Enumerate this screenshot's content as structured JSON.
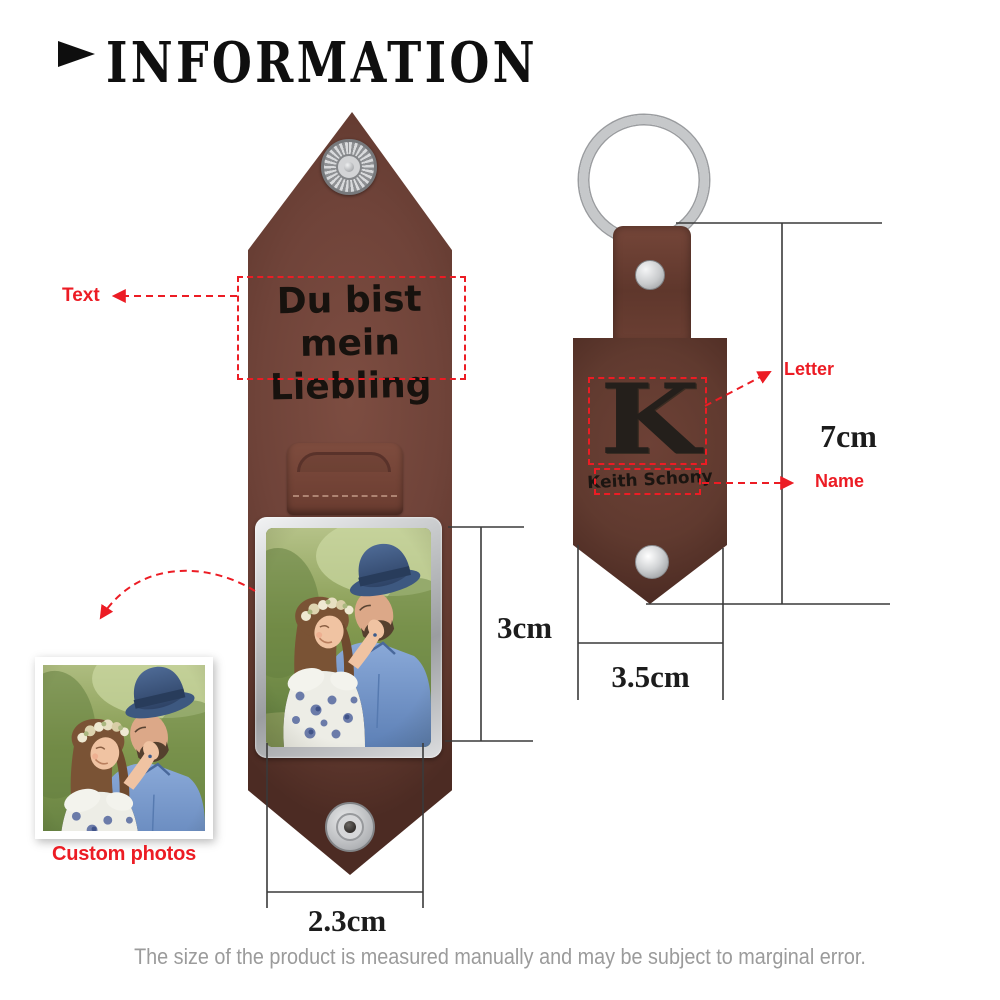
{
  "header": {
    "title": "INFORMATION",
    "arrow_icon": "right-triangle"
  },
  "left_keychain": {
    "engraving_line1": "Du bist mein",
    "engraving_line2": "Liebling",
    "photo_subject": "couple-photo"
  },
  "right_keychain": {
    "letter": "K",
    "name": "Keith Schony"
  },
  "annotations": {
    "text_label": "Text",
    "custom_photos_label": "Custom photos",
    "letter_label": "Letter",
    "name_label": "Name"
  },
  "dimensions": {
    "photo_height": "3cm",
    "photo_width": "2.3cm",
    "keychain_height": "7cm",
    "keychain_width": "3.5cm"
  },
  "footer": {
    "disclaimer": "The size of the product is measured manually and may be subject to marginal error."
  },
  "colors": {
    "annotation_red": "#ec1c24",
    "leather_brown": "#6f4339",
    "leather_dark_brown": "#5f392e",
    "metal_silver": "#c6c8ca",
    "dimension_line": "#3a3a3a",
    "disclaimer_gray": "#9b9b9b"
  }
}
